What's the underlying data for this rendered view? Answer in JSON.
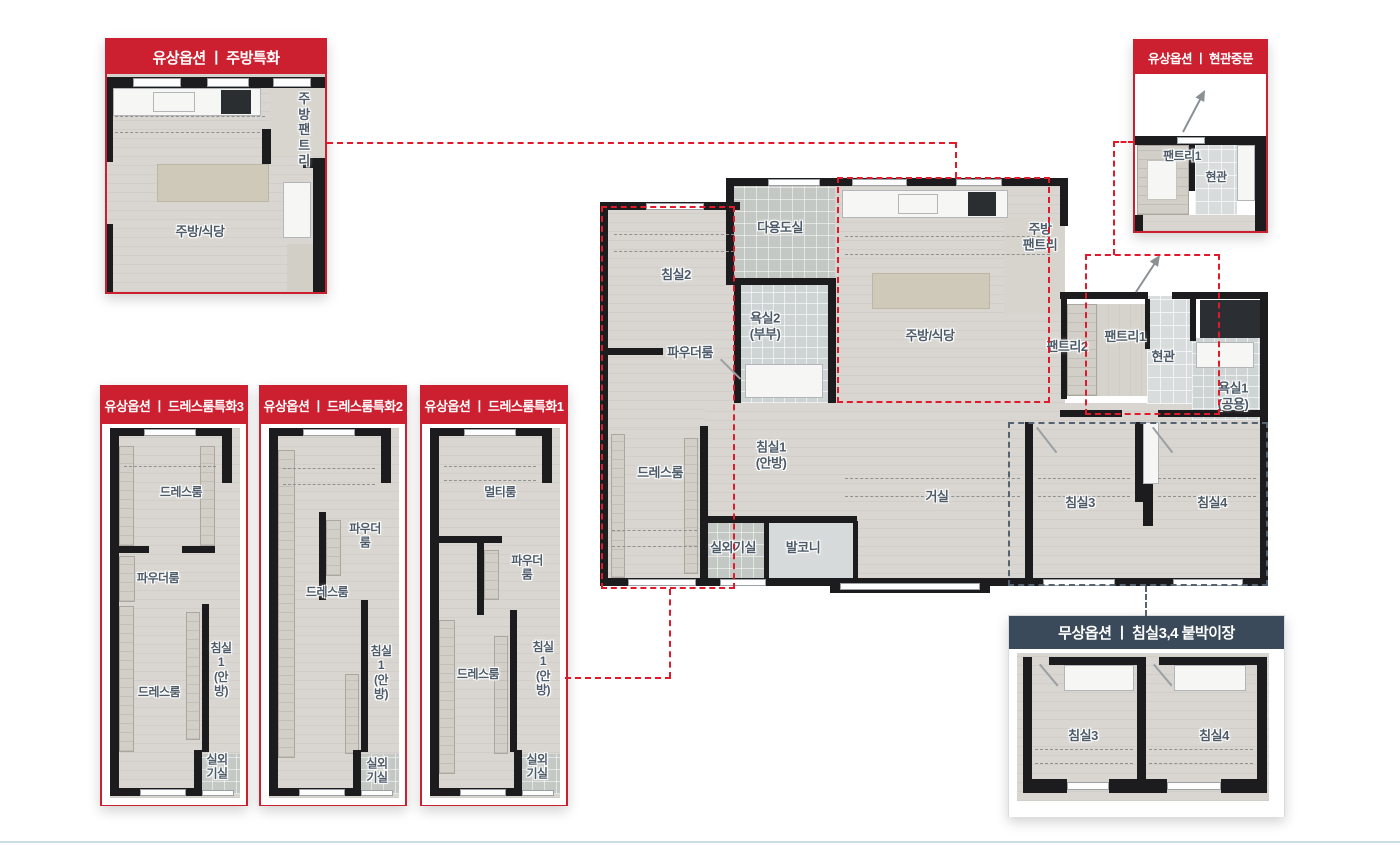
{
  "colors": {
    "paid_option_red": "#cc2030",
    "free_option_navy": "#3b4a5a",
    "leader_dash_red": "#e01a2b",
    "leader_dash_navy": "#55626f",
    "wall_black": "#1c1c1e",
    "floor_wood": "#d9d5d0",
    "floor_tile": "#ced3d4",
    "room_label": "#4d5b69"
  },
  "insets": {
    "kitchen": {
      "title": "유상옵션 ㅣ 주방특화",
      "rooms": [
        {
          "label": "주방\n팬트리"
        },
        {
          "label": "주방/식당"
        }
      ]
    },
    "entrance": {
      "title": "유상옵션 ㅣ 현관중문",
      "rooms": [
        {
          "label": "팬트리1"
        },
        {
          "label": "현관"
        }
      ]
    }
  },
  "main_plan": {
    "rooms": [
      {
        "label": "다용도실"
      },
      {
        "label": "침실2"
      },
      {
        "label": "욕실2\n(부부)"
      },
      {
        "label": "파우더룸"
      },
      {
        "label": "주방/식당"
      },
      {
        "label": "주방\n팬트리"
      },
      {
        "label": "팬트리2"
      },
      {
        "label": "팬트리1"
      },
      {
        "label": "현관"
      },
      {
        "label": "욕실1\n(공용)"
      },
      {
        "label": "드레스룸"
      },
      {
        "label": "침실1\n(안방)"
      },
      {
        "label": "실외기실"
      },
      {
        "label": "발코니"
      },
      {
        "label": "거실"
      },
      {
        "label": "침실3"
      },
      {
        "label": "침실4"
      }
    ]
  },
  "option_panels": [
    {
      "title": "유상옵션 ㅣ 드레스룸특화3",
      "rooms": [
        {
          "label": "드레스룸"
        },
        {
          "label": "파우더룸"
        },
        {
          "label": "침실1\n(안방)"
        },
        {
          "label": "드레스룸"
        },
        {
          "label": "실외기실"
        }
      ]
    },
    {
      "title": "유상옵션 ㅣ 드레스룸특화2",
      "rooms": [
        {
          "label": "파우더룸"
        },
        {
          "label": "드레스룸"
        },
        {
          "label": "침실1\n(안방)"
        },
        {
          "label": "실외기실"
        }
      ]
    },
    {
      "title": "유상옵션 ㅣ 드레스룸특화1",
      "rooms": [
        {
          "label": "멀티룸"
        },
        {
          "label": "파우더룸"
        },
        {
          "label": "드레스룸"
        },
        {
          "label": "침실1\n(안방)"
        },
        {
          "label": "실외기실"
        }
      ]
    }
  ],
  "free_option_panel": {
    "title": "무상옵션 ㅣ 침실3,4 붙박이장",
    "rooms": [
      {
        "label": "침실3"
      },
      {
        "label": "침실4"
      }
    ]
  }
}
